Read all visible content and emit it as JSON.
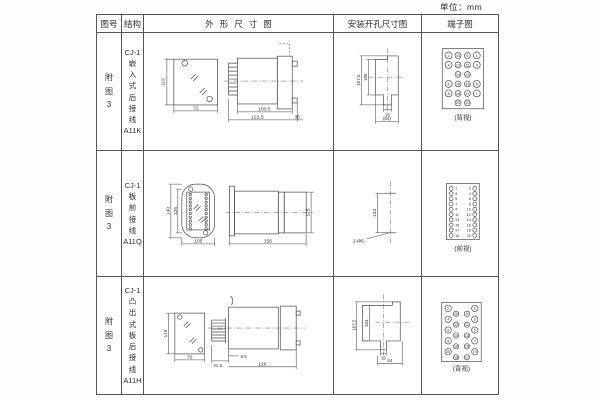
{
  "unit_label": "单位：mm",
  "header": {
    "fig_no": "图号",
    "structure": "结构",
    "outline": "外形尺寸图",
    "mounting": "安装开孔尺寸图",
    "terminal": "端子图"
  },
  "rows": [
    {
      "fig_no": "附\n图\n3",
      "structure": "CJ-1\n嵌\n入\n式\n后\n接\n线\nA11K",
      "outline": {
        "front_height": "115",
        "front_width": "72",
        "depth_body": "100.5",
        "depth_total": "122.5",
        "flange_depth": "35"
      },
      "mounting": {
        "height_outer": "107.5",
        "height_inner": "105",
        "notch_width": "16",
        "opening_width": "(64)"
      },
      "terminal": {
        "view": "(背视)",
        "numbers": [
          "2",
          "10",
          "9",
          "1",
          "4",
          "12",
          "11",
          "3",
          "14",
          "13",
          "6",
          "16",
          "15",
          "5",
          "8",
          "18",
          "17",
          "7",
          "20",
          "19"
        ]
      }
    },
    {
      "fig_no": "附\n图\n3",
      "structure": "CJ-1\n板\n前\n接\n线\nA11Q",
      "outline": {
        "front_height_outer": "140",
        "front_height_inner": "125",
        "front_width": "105",
        "side_height": "115",
        "depth_total": "156"
      },
      "mounting": {
        "hole_distance": "133",
        "hole_spec": "2-Φ5"
      },
      "terminal": {
        "view": "(前视)",
        "numbers": [
          "1",
          "2",
          "3",
          "4",
          "5",
          "6",
          "7",
          "8",
          "9",
          "10",
          "11",
          "12",
          "13",
          "14",
          "15",
          "16",
          "17",
          "18",
          "19",
          "20"
        ]
      }
    },
    {
      "fig_no": "附\n图\n3",
      "structure": "CJ-1\n凸\n出\n式\n板\n后\n接\n线\nA11H",
      "outline": {
        "front_height": "115",
        "front_width": "72",
        "fin_depth": "31.5",
        "offset": "9.5",
        "depth_total": "126"
      },
      "mounting": {
        "height_outer": "107.5",
        "height_inner": "104",
        "notch_width": "16",
        "opening_width": "64"
      },
      "terminal": {
        "view": "(背视)",
        "numbers": [
          "2",
          "10",
          "4",
          "12",
          "6",
          "14",
          "8",
          "16",
          "20",
          "18",
          "1",
          "9",
          "3",
          "11",
          "5",
          "13",
          "7",
          "15",
          "19",
          "17"
        ]
      }
    }
  ]
}
